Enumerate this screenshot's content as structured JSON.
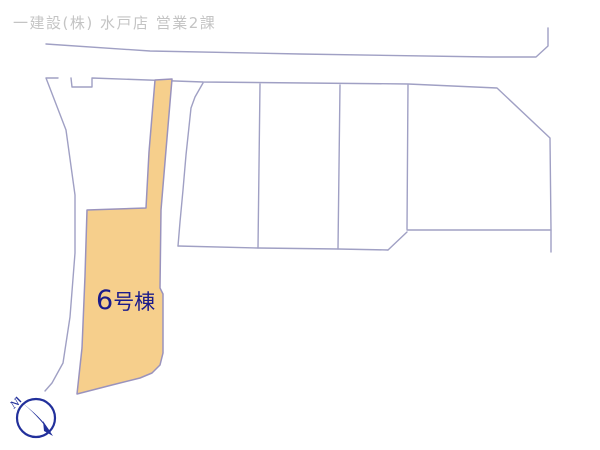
{
  "header": {
    "company": "一建設(株) 水戸店 営業2課"
  },
  "map": {
    "highlight_lot": {
      "label": "6号棟",
      "label_number": "6",
      "label_suffix": "号棟"
    }
  },
  "compass": {
    "north_label": "N"
  },
  "colors": {
    "background": "#ffffff",
    "header_text": "#c4c4c4",
    "line": "#a0a0c4",
    "lot_fill": "#f6cf8c",
    "lot_stroke": "#9a93bd",
    "lot_label": "#1b1b8a",
    "compass": "#22309b"
  }
}
